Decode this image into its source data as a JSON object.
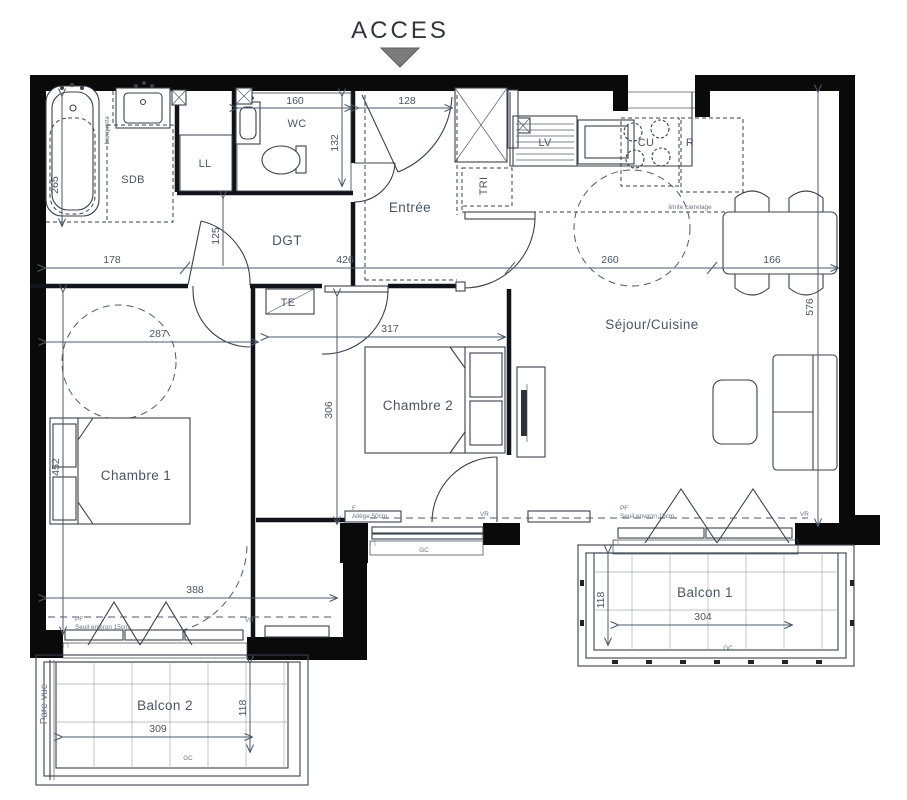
{
  "header": {
    "acces": "ACCES"
  },
  "rooms": {
    "sdb": "SDB",
    "wc": "WC",
    "ll": "LL",
    "dgt": "DGT",
    "entree": "Entrée",
    "tri": "TRI",
    "lv": "LV",
    "cu": "CU",
    "r": "R",
    "te": "TE",
    "sejour": "Séjour/Cuisine",
    "chambre1": "Chambre 1",
    "chambre2": "Chambre 2",
    "balcon1": "Balcon 1",
    "balcon2": "Balcon 2"
  },
  "dims": {
    "tub": "265",
    "wc_w": "160",
    "entry": "128",
    "wc_h": "132",
    "dgt_h": "125",
    "left": "178",
    "mid": "426",
    "kitchen": "260",
    "table": "166",
    "sejour_h": "576",
    "ch1_w": "287",
    "ch2_w": "317",
    "ch2_h": "306",
    "ch1_h": "452",
    "ch1_bottom": "388",
    "b2_depth": "118",
    "b2_w": "309",
    "b1_depth": "118",
    "b1_w": "304"
  },
  "annotations": {
    "banquette": "banquette",
    "pare_vue": "Pare-vue",
    "limite": "limite carrelage",
    "gc": "GC",
    "pf": "PF",
    "f": "F",
    "seuil": "Seuil environ 15cm",
    "allege": "Allège 50cm",
    "vr": "VR"
  }
}
